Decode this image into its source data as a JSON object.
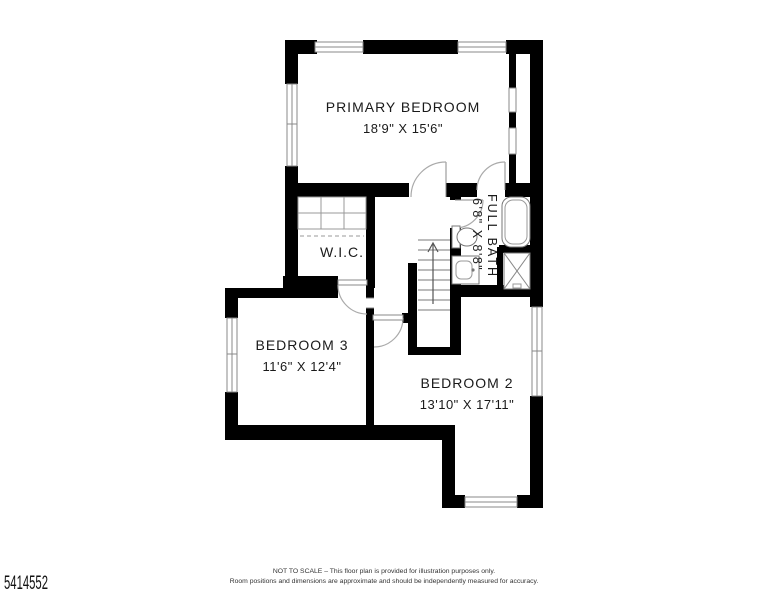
{
  "plan": {
    "rooms": {
      "primary_bedroom": {
        "name": "PRIMARY BEDROOM",
        "dims": "18'9\" X 15'6\""
      },
      "full_bath": {
        "name": "FULL BATH",
        "dims": "6'8\" X 8'8\""
      },
      "wic": {
        "name": "W.I.C."
      },
      "bedroom_3": {
        "name": "BEDROOM 3",
        "dims": "11'6\" X 12'4\""
      },
      "bedroom_2": {
        "name": "BEDROOM 2",
        "dims": "13'10\" X 17'11\""
      }
    },
    "stairs": {
      "direction": "up"
    }
  },
  "footer": {
    "listing_id": "5414552",
    "disclaimer_line1": "NOT TO SCALE – This floor plan is provided for illustration purposes only.",
    "disclaimer_line2": "Room positions and dimensions are approximate and should be independently measured for accuracy."
  },
  "colors": {
    "wall": "#000000",
    "background": "#ffffff",
    "thin_line": "#888888",
    "door_arc": "#aaaaaa"
  }
}
